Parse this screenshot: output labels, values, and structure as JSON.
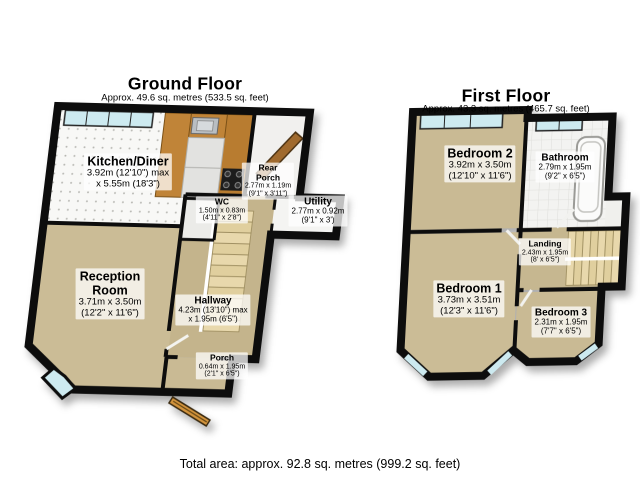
{
  "ground_floor": {
    "title": "Ground Floor",
    "subtitle": "Approx. 49.6 sq. metres (533.5 sq. feet)",
    "rooms": {
      "kitchen_diner": {
        "name": "Kitchen/Diner",
        "dims": "3.92m (12'10\") max\nx 5.55m (18'3\")"
      },
      "rear_porch": {
        "name": "Rear\nPorch",
        "dims": "2.77m x 1.19m\n(9'1\" x 3'11\")"
      },
      "wc": {
        "name": "WC",
        "dims": "1.50m x 0.83m\n(4'11\" x 2'8\")"
      },
      "utility": {
        "name": "Utility",
        "dims": "2.77m x 0.92m\n(9'1\" x 3')"
      },
      "reception_room": {
        "name": "Reception\nRoom",
        "dims": "3.71m x 3.50m\n(12'2\" x 11'6\")"
      },
      "hallway": {
        "name": "Hallway",
        "dims": "4.23m (13'10\") max\nx 1.95m (6'5\")"
      },
      "porch": {
        "name": "Porch",
        "dims": "0.64m x 1.95m\n(2'1\" x 6'5\")"
      }
    }
  },
  "first_floor": {
    "title": "First Floor",
    "subtitle": "Approx. 43.3 sq. metres (465.7 sq. feet)",
    "rooms": {
      "bedroom_2": {
        "name": "Bedroom 2",
        "dims": "3.92m x 3.50m\n(12'10\" x 11'6\")"
      },
      "bathroom": {
        "name": "Bathroom",
        "dims": "2.79m x 1.95m\n(9'2\" x 6'5\")"
      },
      "landing": {
        "name": "Landing",
        "dims": "2.43m x 1.95m\n(8' x 6'5\")"
      },
      "bedroom_1": {
        "name": "Bedroom 1",
        "dims": "3.73m x 3.51m\n(12'3\" x 11'6\")"
      },
      "bedroom_3": {
        "name": "Bedroom 3",
        "dims": "2.31m x 1.95m\n(7'7\" x 6'5\")"
      }
    }
  },
  "footer": {
    "total_area": "Total area: approx. 92.8 sq. metres (999.2 sq. feet)"
  },
  "colors": {
    "floor_beige": "#c9ba93",
    "wall_black": "#0d0d0d",
    "window_glass": "#cdeaf0",
    "stairs_cream": "#e8d8ac",
    "counter_wood": "#c08438",
    "door_wood": "#a06a2e",
    "label_background": "rgba(255,255,255,0.74)"
  }
}
